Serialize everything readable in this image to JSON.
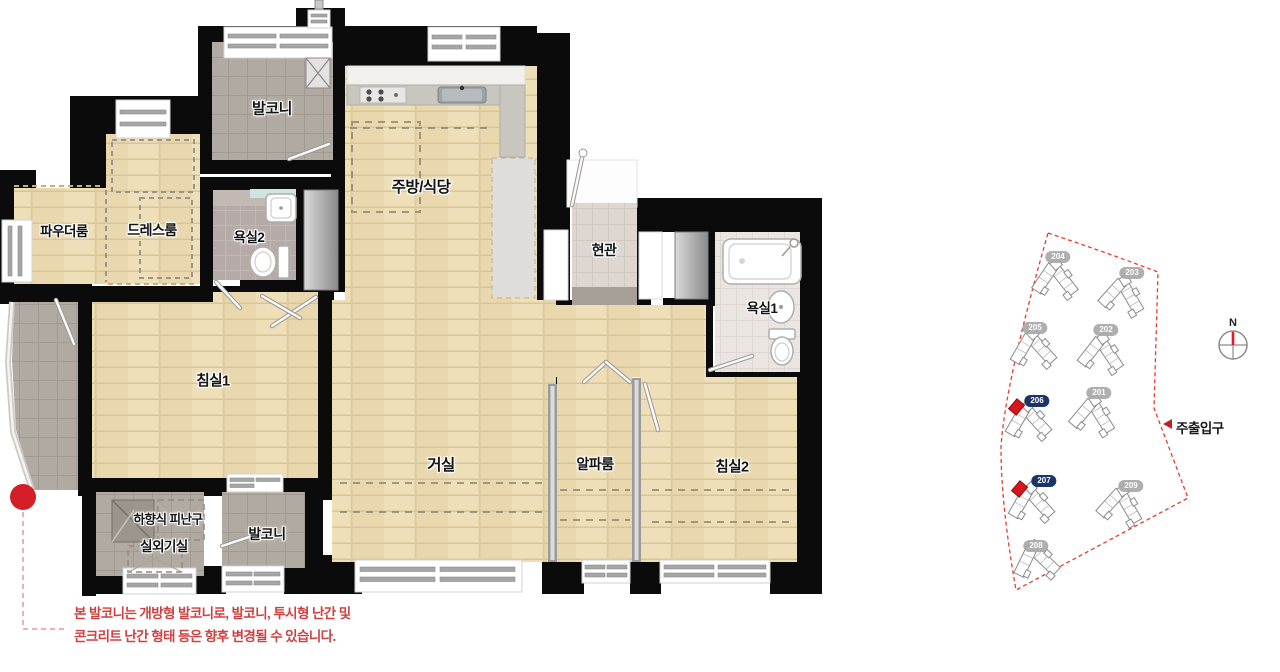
{
  "floorplan": {
    "rooms": {
      "balcony_top": "발코니",
      "kitchen_dining": "주방/식당",
      "powder_room": "파우더룸",
      "dress_room": "드레스룸",
      "bathroom2": "욕실2",
      "entrance": "현관",
      "bathroom1": "욕실1",
      "bedroom1": "침실1",
      "living_room": "거실",
      "alpha_room": "알파룸",
      "bedroom2": "침실2",
      "evac_hatch": "하향식 피난구",
      "outdoor_unit_room": "실외기실",
      "balcony_bottom": "발코니"
    },
    "notice": {
      "line1": "본 발코니는 개방형 발코니로, 발코니, 투시형 난간 및",
      "line2": "콘크리트 난간 형태 등은 향후 변경될 수 있습니다.",
      "color": "#cf4141"
    },
    "colors": {
      "wall": "#0b0b0b",
      "wood_floor": "#e9d7ad",
      "balcony_tile": "#b1aaa2",
      "marker_red": "#d41f26"
    }
  },
  "siteplan": {
    "buildings": [
      {
        "label": "204",
        "highlight": false
      },
      {
        "label": "203",
        "highlight": false
      },
      {
        "label": "205",
        "highlight": false
      },
      {
        "label": "202",
        "highlight": false
      },
      {
        "label": "206",
        "highlight": true
      },
      {
        "label": "201",
        "highlight": false
      },
      {
        "label": "207",
        "highlight": true
      },
      {
        "label": "209",
        "highlight": false
      },
      {
        "label": "208",
        "highlight": false
      }
    ],
    "compass_label": "N",
    "main_entrance_label": "주출입구",
    "boundary_color": "#ea3b2d",
    "badge_navy": "#1c3468",
    "unit_red": "#d6161d"
  }
}
